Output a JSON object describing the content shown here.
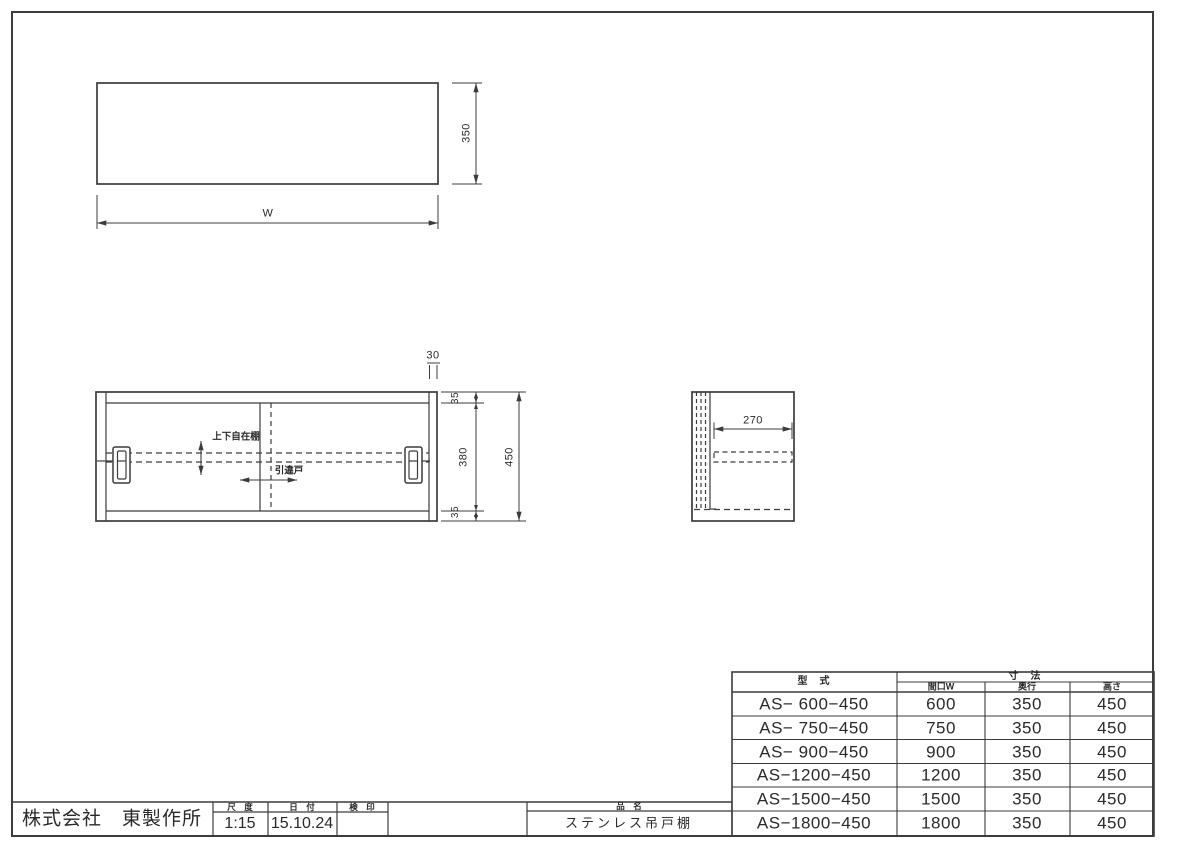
{
  "colors": {
    "line": "#3c3c3c",
    "text": "#2a2a2a",
    "background": "#ffffff"
  },
  "dimensions": {
    "top_view": {
      "depth": "350",
      "width": "W"
    },
    "front_view": {
      "door_thickness": "30",
      "top_frame": "35",
      "interior": "380",
      "bottom_frame": "35",
      "total_height": "450"
    },
    "side_view": {
      "shelf_depth": "270"
    }
  },
  "annotations": {
    "adjustable_shelf": "上下自在棚",
    "sliding_door": "引違戸"
  },
  "spec_table": {
    "col_model": "型　式",
    "col_dims_group": "寸　法",
    "col_width": "間口W",
    "col_depth": "奥行",
    "col_height": "高さ",
    "rows": [
      {
        "model": "AS− 600−450",
        "width": "600",
        "depth": "350",
        "height": "450"
      },
      {
        "model": "AS− 750−450",
        "width": "750",
        "depth": "350",
        "height": "450"
      },
      {
        "model": "AS− 900−450",
        "width": "900",
        "depth": "350",
        "height": "450"
      },
      {
        "model": "AS−1200−450",
        "width": "1200",
        "depth": "350",
        "height": "450"
      },
      {
        "model": "AS−1500−450",
        "width": "1500",
        "depth": "350",
        "height": "450"
      },
      {
        "model": "AS−1800−450",
        "width": "1800",
        "depth": "350",
        "height": "450"
      }
    ]
  },
  "title_block": {
    "company": "株式会社　東製作所",
    "scale_label": "尺　度",
    "scale_value": "1:15",
    "date_label": "日　付",
    "date_value": "15.10.24",
    "stamp_label": "検　印",
    "stamp_value": "",
    "product_label": "品　名",
    "product_value": "ステンレス吊戸棚"
  }
}
